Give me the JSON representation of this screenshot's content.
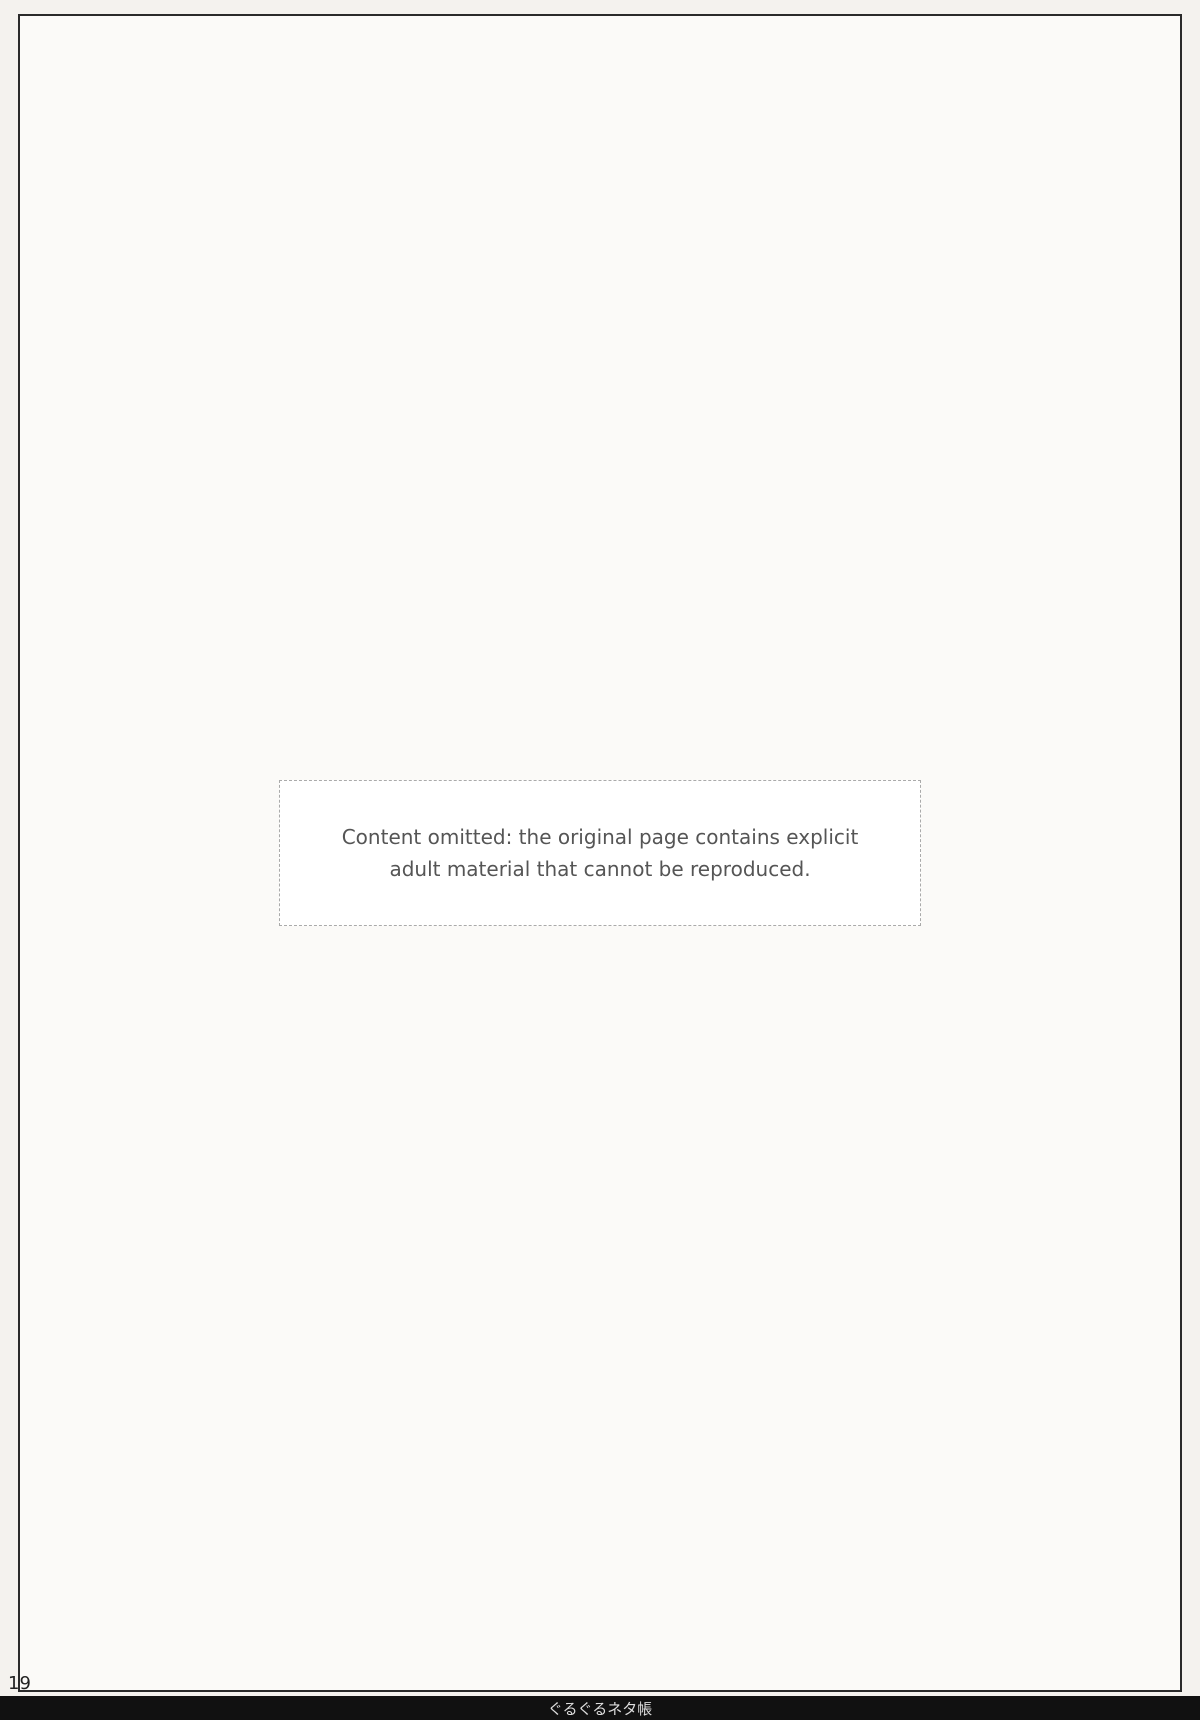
{
  "page": {
    "number": "19",
    "footer_title": "ぐるぐるネタ帳",
    "notice": "Content omitted: the original page contains explicit adult material that cannot be reproduced."
  }
}
